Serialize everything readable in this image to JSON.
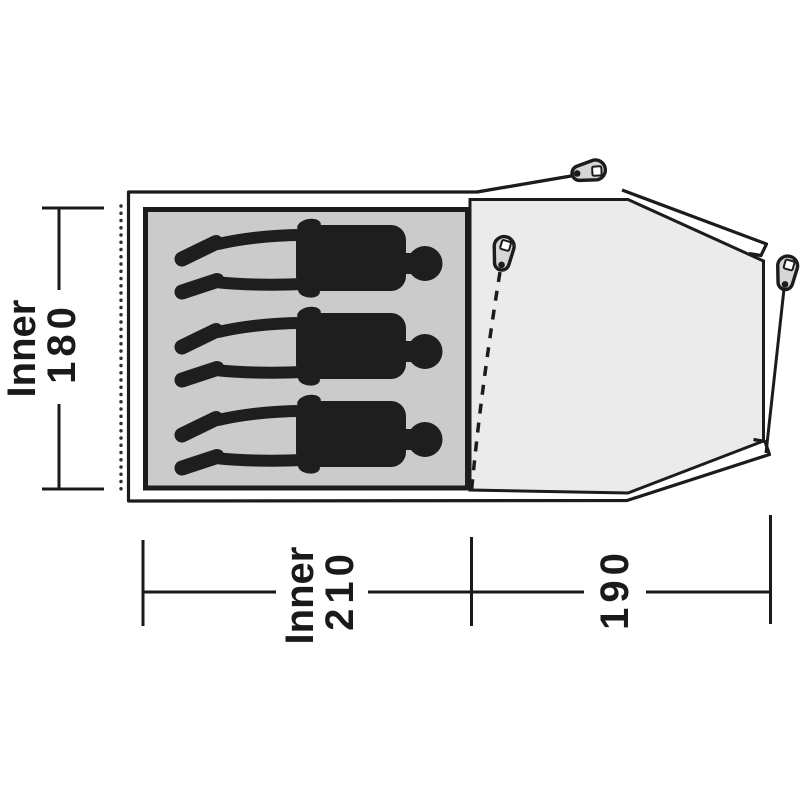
{
  "figure": {
    "type": "tent-floorplan-top-view",
    "sleeping_capacity": 3,
    "colors": {
      "background": "#ffffff",
      "outline": "#1c1c1c",
      "inner_mat": "#cbcbcb",
      "porch_floor": "#ebebeb",
      "peg_fill": "#d6d6d6",
      "silhouette": "#1e1e1e",
      "label_text": "#1a1a1a",
      "attachment_dots": "#2f2f2f"
    },
    "dimensions": {
      "inner_height": {
        "label": "Inner",
        "value": "180"
      },
      "inner_width": {
        "label": "Inner",
        "value": "210"
      },
      "porch_depth": {
        "value": "190"
      }
    }
  }
}
